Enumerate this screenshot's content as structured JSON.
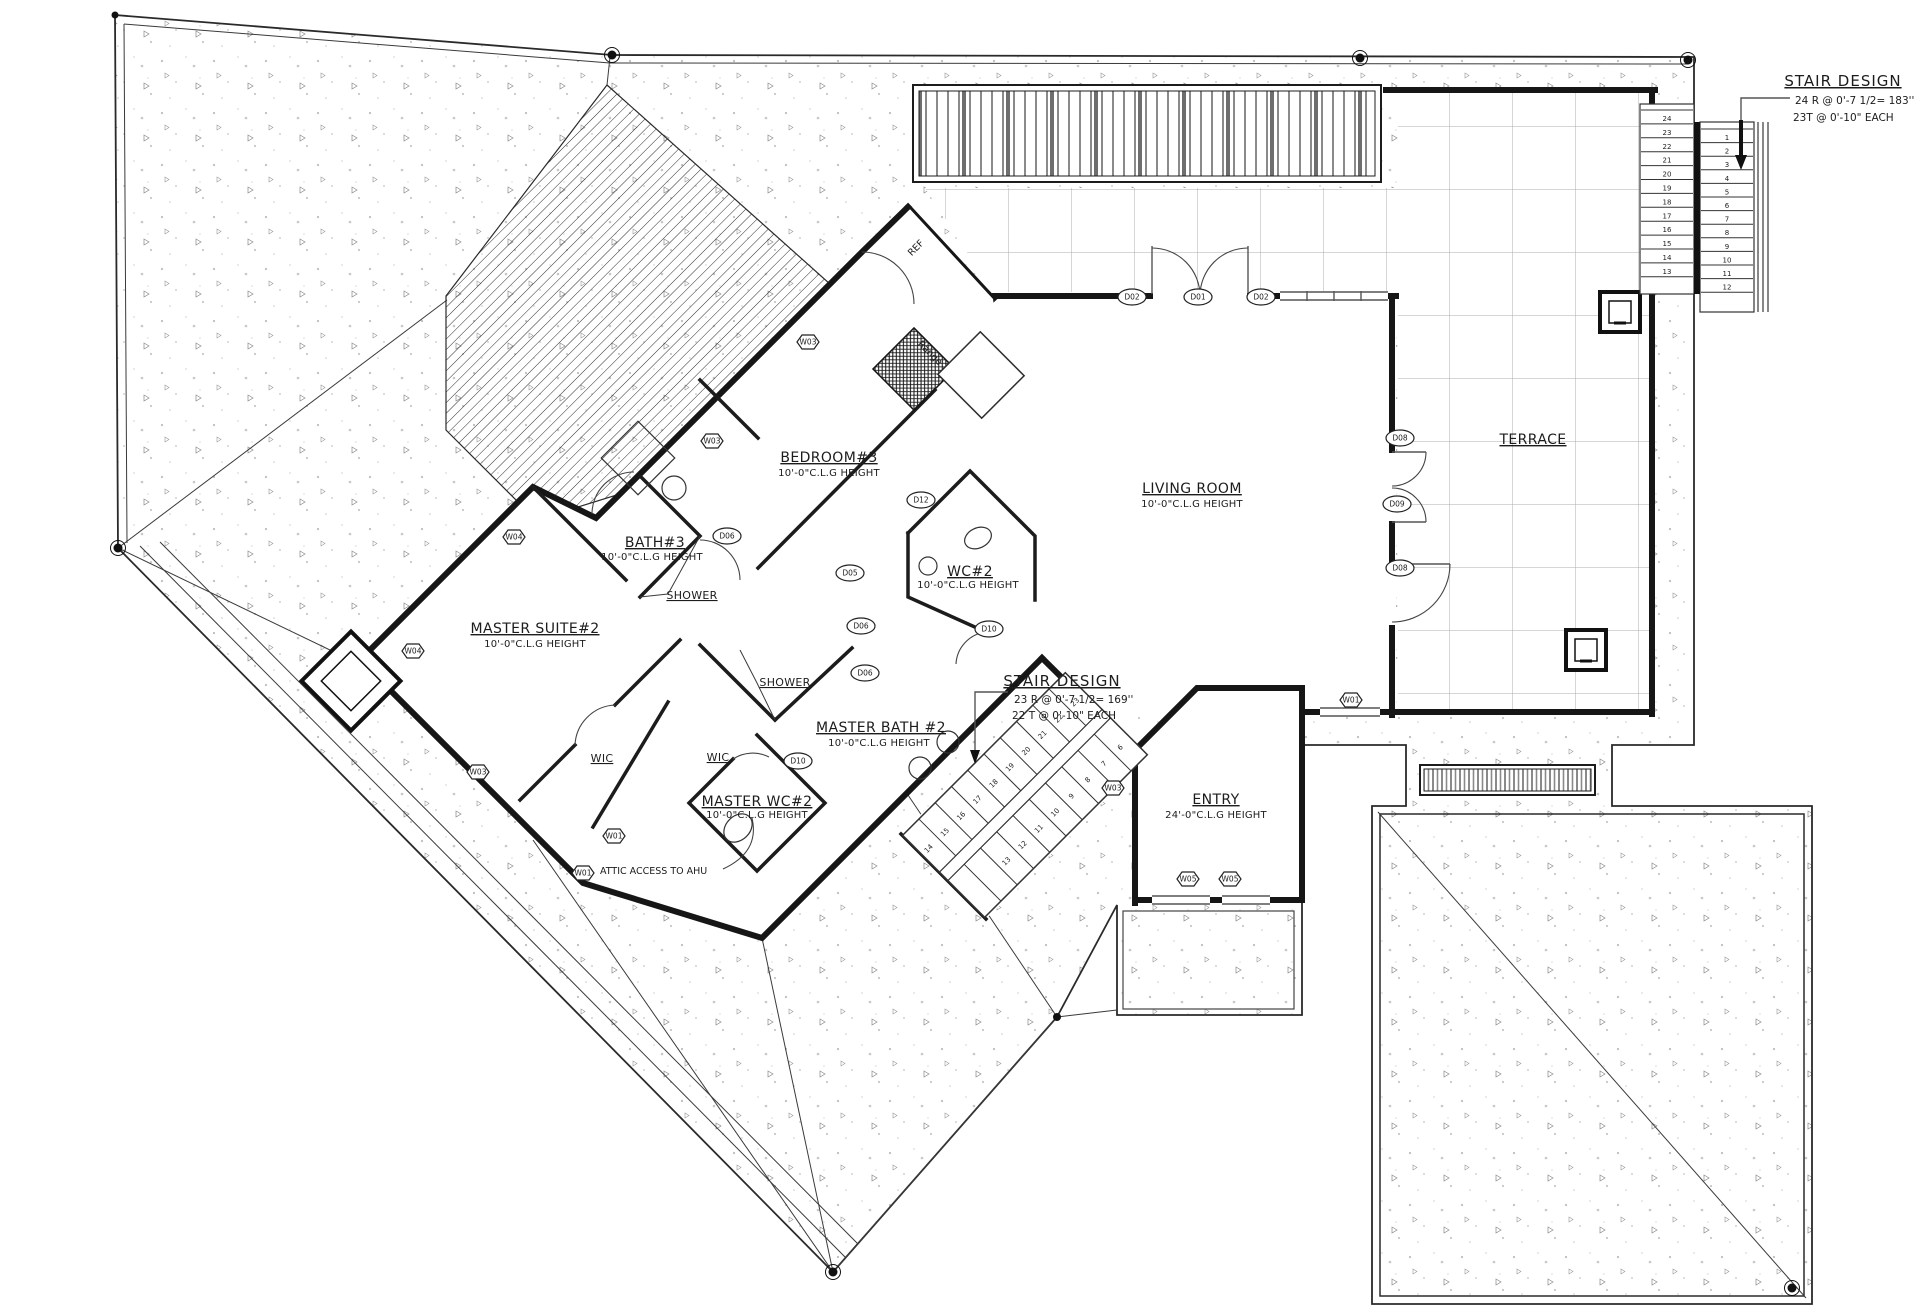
{
  "plan": {
    "rooms": [
      {
        "id": "living-room",
        "name": "LIVING ROOM",
        "height": "10'-0\"C.L.G HEIGHT"
      },
      {
        "id": "terrace",
        "name": "TERRACE",
        "height": ""
      },
      {
        "id": "bedroom-3",
        "name": "BEDROOM#3",
        "height": "10'-0\"C.L.G HEIGHT"
      },
      {
        "id": "bath-3",
        "name": "BATH#3",
        "height": "10'-0\"C.L.G HEIGHT"
      },
      {
        "id": "master-suite-2",
        "name": "MASTER SUITE#2",
        "height": "10'-0\"C.L.G HEIGHT"
      },
      {
        "id": "wc-2",
        "name": "WC#2",
        "height": "10'-0\"C.L.G HEIGHT"
      },
      {
        "id": "master-bath-2",
        "name": "MASTER BATH #2",
        "height": "10'-0\"C.L.G HEIGHT"
      },
      {
        "id": "master-wc-2",
        "name": "MASTER WC#2",
        "height": "10'-0\"C.L.G HEIGHT"
      },
      {
        "id": "entry",
        "name": "ENTRY",
        "height": "24'-0\"C.L.G HEIGHT"
      },
      {
        "id": "wic-left",
        "name": "WIC"
      },
      {
        "id": "wic-right",
        "name": "WIC"
      },
      {
        "id": "shower-upper",
        "name": "SHOWER"
      },
      {
        "id": "shower-lower",
        "name": "SHOWER"
      }
    ],
    "stairs": {
      "upper": {
        "title": "STAIR DESIGN",
        "note1": "24 R @   0'-7 1/2= 183''",
        "note2": "23T @ 0'-10\" EACH",
        "left_run": [
          24,
          23,
          22,
          21,
          20,
          19,
          18,
          17,
          16,
          15,
          14,
          13
        ],
        "right_run": [
          1,
          2,
          3,
          4,
          5,
          6,
          7,
          8,
          9,
          10,
          11,
          12
        ]
      },
      "main": {
        "title": "STAIR DESIGN",
        "note1": "23 R @   0'-7 1/2= 169''",
        "note2": "22 T @ 0'-10\" EACH",
        "upper_run": [
          23,
          22,
          21,
          20,
          19,
          18,
          17,
          16,
          15,
          14
        ],
        "lower_run": [
          6,
          7,
          8,
          9,
          10,
          11,
          12,
          13
        ]
      }
    },
    "annotations": {
      "attic_access": "ATTIC ACCESS TO AHU",
      "range": "Range",
      "ref": "REF"
    },
    "window_tags": [
      {
        "label": "W03"
      },
      {
        "label": "W03"
      },
      {
        "label": "W04"
      },
      {
        "label": "W04"
      },
      {
        "label": "W03"
      },
      {
        "label": "W01"
      },
      {
        "label": "W01"
      },
      {
        "label": "W05"
      },
      {
        "label": "W05"
      },
      {
        "label": "W01"
      },
      {
        "label": "W03"
      }
    ],
    "door_tags": [
      {
        "label": "D02"
      },
      {
        "label": "D01"
      },
      {
        "label": "D02"
      },
      {
        "label": "D08"
      },
      {
        "label": "D09"
      },
      {
        "label": "D08"
      },
      {
        "label": "D12"
      },
      {
        "label": "D05"
      },
      {
        "label": "D06"
      },
      {
        "label": "D06"
      },
      {
        "label": "D06"
      },
      {
        "label": "D10"
      },
      {
        "label": "D10"
      }
    ],
    "colors": {
      "ink": "#1c1c1c",
      "grid": "#b0b0b0",
      "speckle": "#8f8f8f"
    }
  }
}
